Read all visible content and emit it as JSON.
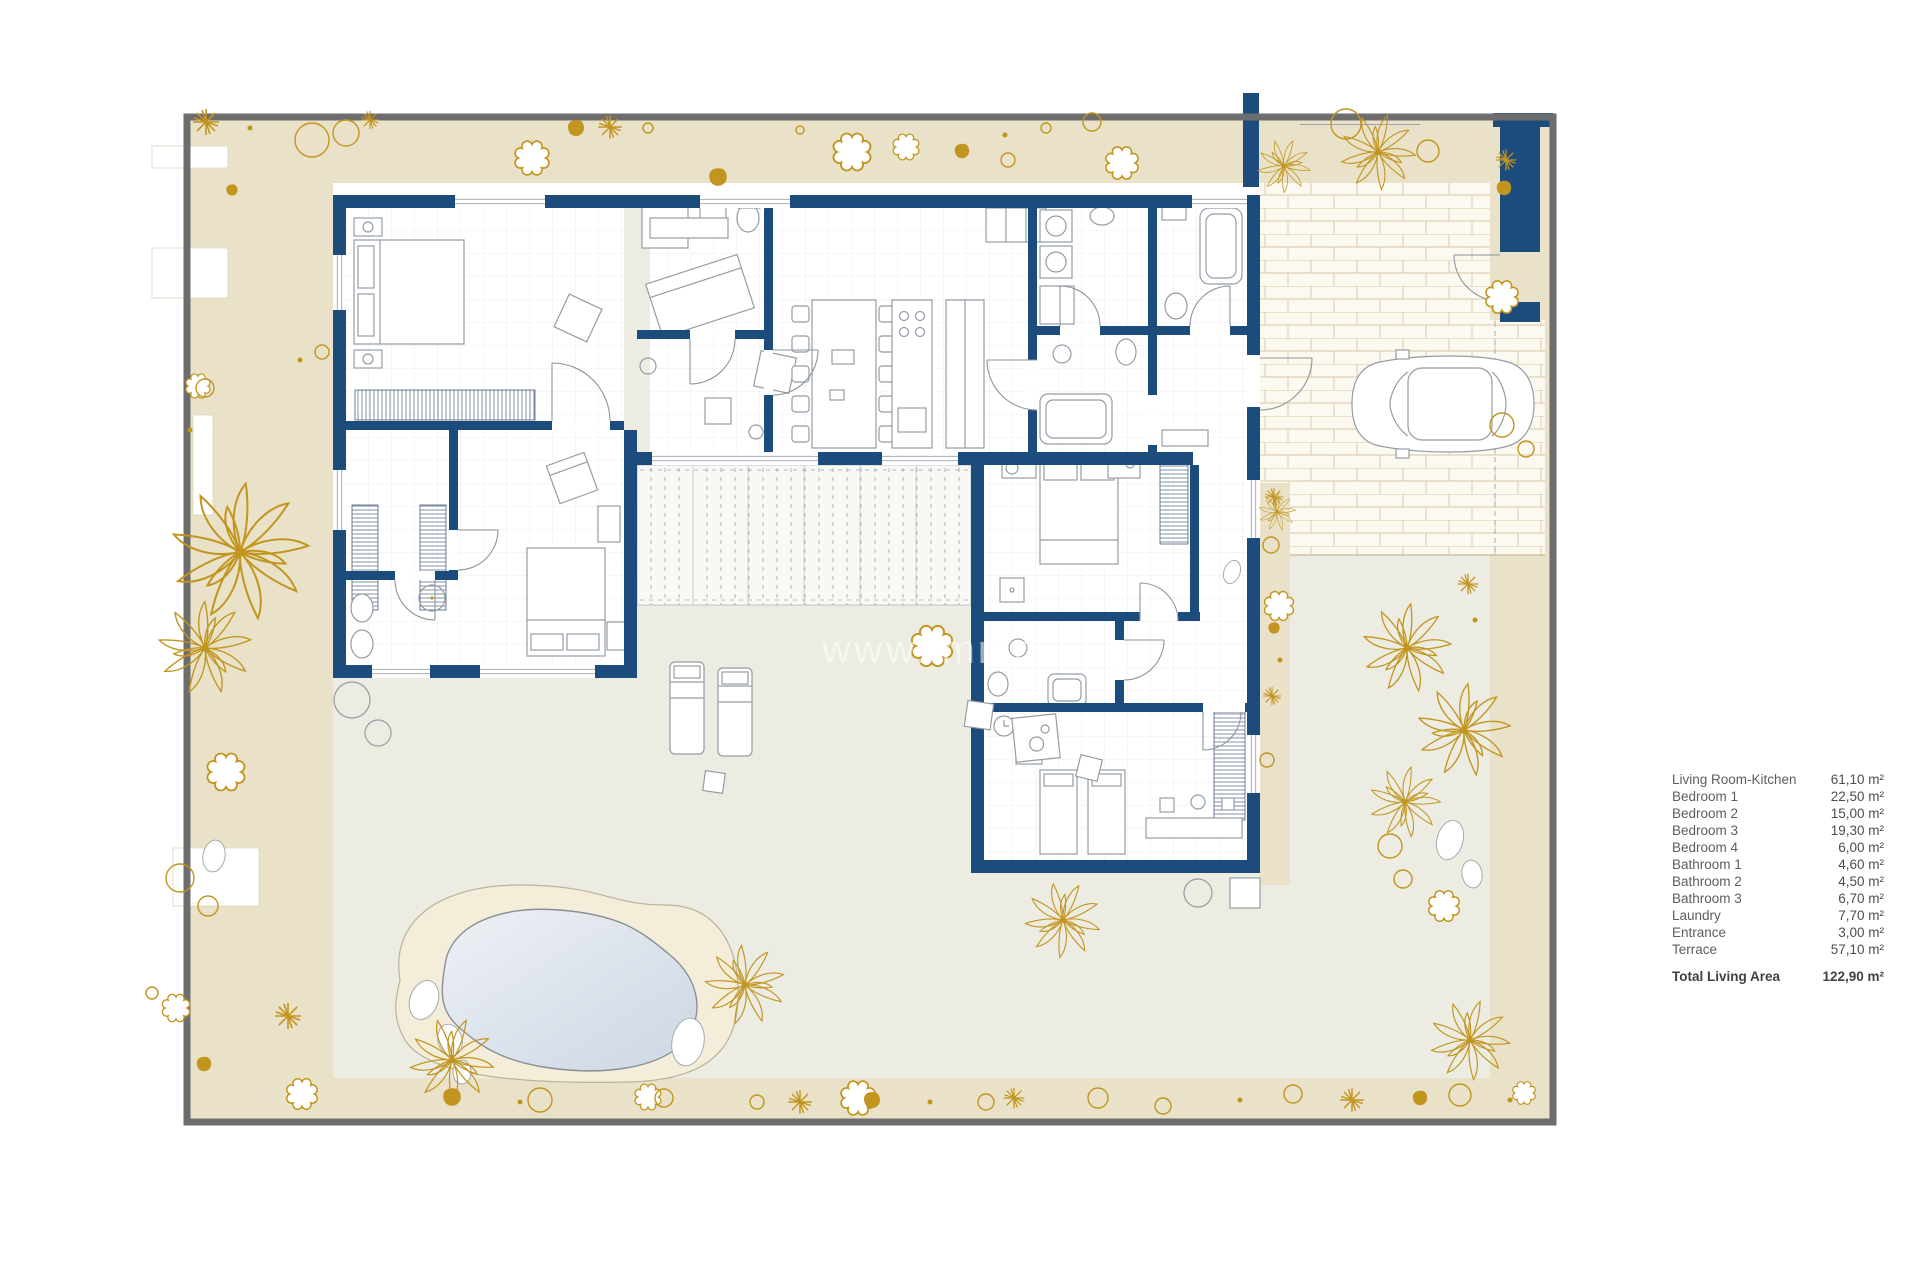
{
  "watermark": {
    "text": "www.immo"
  },
  "legend": {
    "items": [
      {
        "label": "Living Room-Kitchen",
        "area": "61,10 m²"
      },
      {
        "label": "Bedroom 1",
        "area": "22,50 m²"
      },
      {
        "label": "Bedroom 2",
        "area": "15,00 m²"
      },
      {
        "label": "Bedroom 3",
        "area": "19,30 m²"
      },
      {
        "label": "Bedroom 4",
        "area": "6,00 m²"
      },
      {
        "label": "Bathroom 1",
        "area": "4,60 m²"
      },
      {
        "label": "Bathroom 2",
        "area": "4,50 m²"
      },
      {
        "label": "Bathroom 3",
        "area": "6,70 m²"
      },
      {
        "label": "Laundry",
        "area": "7,70 m²"
      },
      {
        "label": "Entrance",
        "area": "3,00 m²"
      },
      {
        "label": "Terrace",
        "area": "57,10 m²"
      }
    ],
    "total": {
      "label": "Total Living Area",
      "area": "122,90 m²"
    }
  },
  "colors": {
    "navy": "#1c4c7c",
    "gold": "#c2951f",
    "beige": "#e9e2c8",
    "lawn": "#ecece2",
    "pool-water": "#d9e1eb",
    "pool-deck": "#f4edda",
    "brick-line": "#d9c8a4",
    "plot-border": "#6d6d6d",
    "furniture": "#949ca5",
    "wall-hatch": "#4a5f7e",
    "text": "#5b5e61"
  }
}
